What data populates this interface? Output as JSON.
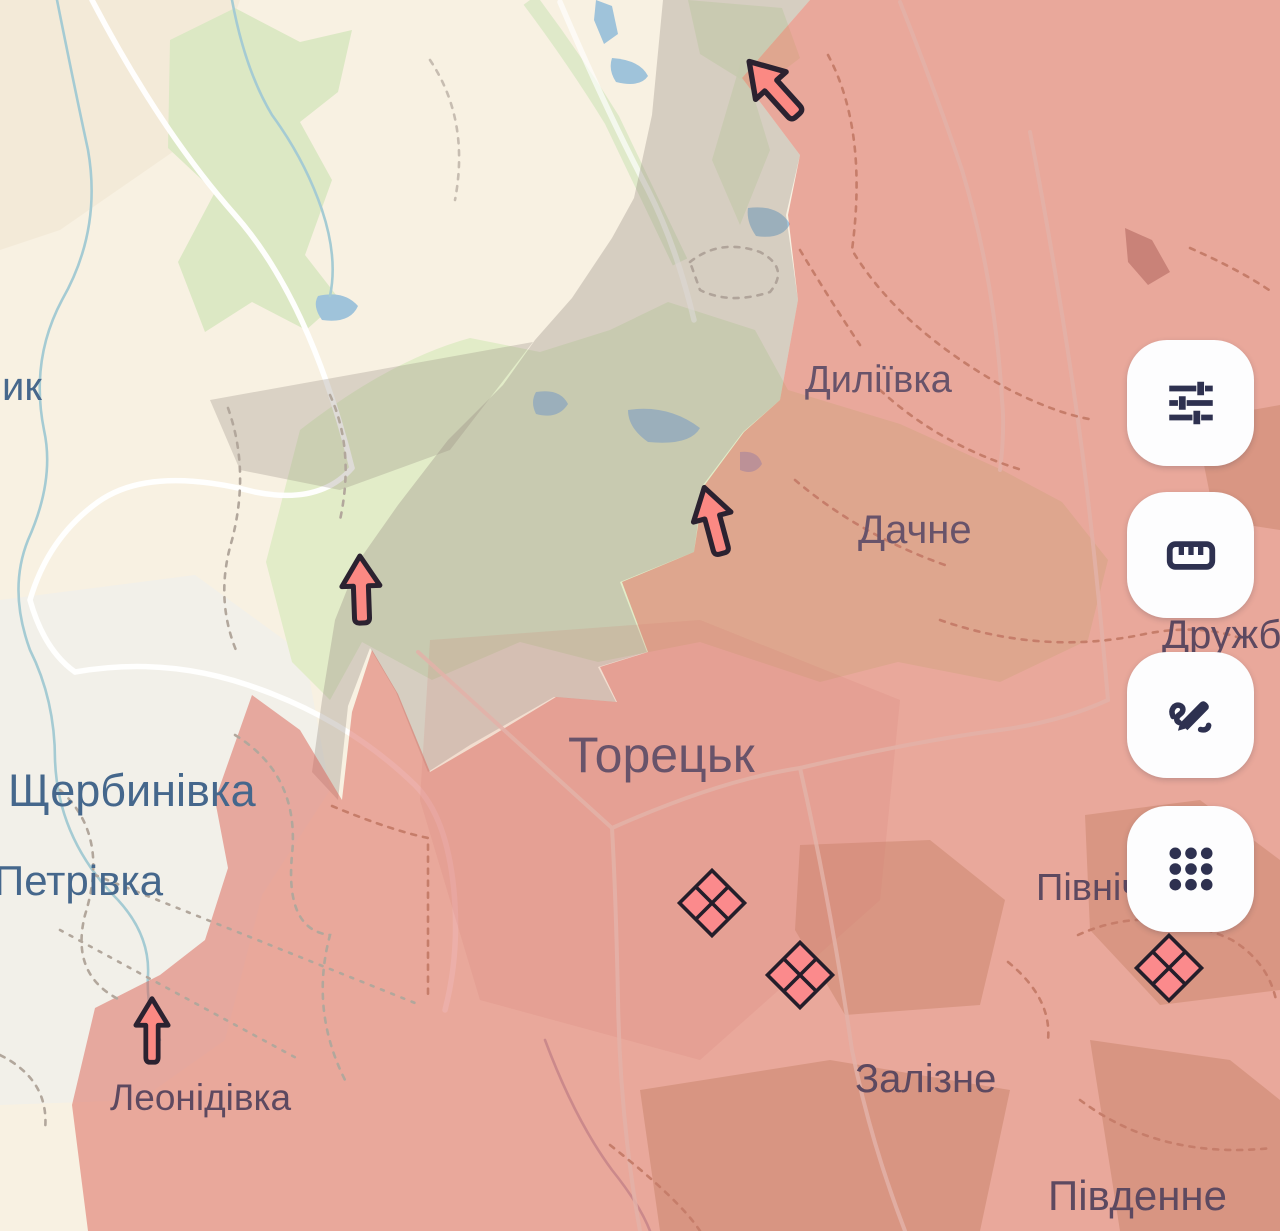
{
  "app": {
    "description": "Interactive war-map view of the Toretsk area with occupied (red) and contested (grey) zones, advance arrows, clash markers and a right-side map toolbar"
  },
  "labels": {
    "toretsk": "Торецьк",
    "dyliivka": "Диліївка",
    "dachne": "Дачне",
    "shcherbynivka": "Щербинівка",
    "petrivka": "Петрівка",
    "leonidivka": "Леонідівка",
    "zalizne": "Залізне",
    "pivdenne": "Південне",
    "pivnichne": "Північне",
    "druzhba": "Дружба",
    "edge_fragment": "ик"
  },
  "toolbar": {
    "buttons": [
      {
        "name": "filters",
        "icon": "sliders-icon"
      },
      {
        "name": "measure",
        "icon": "ruler-icon"
      },
      {
        "name": "draw",
        "icon": "pen-scribble-icon"
      },
      {
        "name": "apps",
        "icon": "grid-dots-icon"
      }
    ]
  },
  "markers": {
    "advance_arrow_count": 4,
    "advance_arrow_directions": [
      "up-left",
      "up-left",
      "up",
      "up"
    ],
    "clash_marker_count": 3
  },
  "colors": {
    "free_area": "#f8f1e2",
    "occupied_overlay": "#da6054",
    "contested_overlay": "#968a80",
    "forest": "#e0ebc6",
    "water": "#9fc3da",
    "arrow_fill": "#fb8983",
    "arrow_outline": "#2b2230",
    "clash_fill": "#fb8a8c",
    "clash_outline": "#241e2a",
    "label_free": "#47688c",
    "label_occupied": "#66506a",
    "icon_color": "#2e3150",
    "button_bg": "#fdfdfe"
  }
}
